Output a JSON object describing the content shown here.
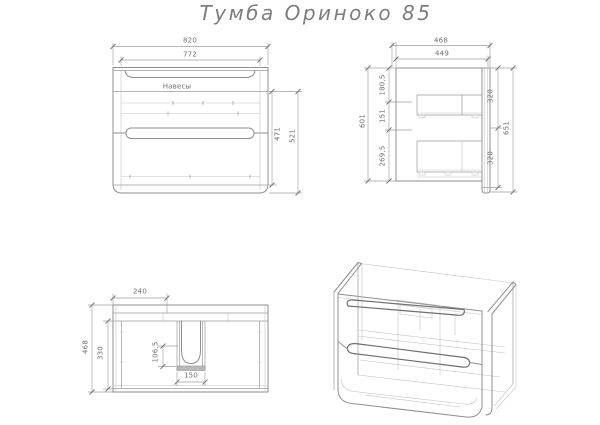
{
  "title": "Тумба  Ориноко  85",
  "front_view": {
    "shelf_label": "Навесы",
    "dim_width_outer": "820",
    "dim_width_inner": "772",
    "dim_height_inner": "471",
    "dim_height_outer": "521"
  },
  "side_view": {
    "dim_depth_outer": "468",
    "dim_depth_inner": "449",
    "dim_top_section": "180,5",
    "dim_mid_section": "151",
    "dim_bottom_section": "269,5",
    "dim_height_back": "601",
    "dim_front_top": "320",
    "dim_front_bottom": "320",
    "dim_height_front": "651"
  },
  "top_view": {
    "dim_offset": "240",
    "dim_depth_outer": "468",
    "dim_depth_inner": "330",
    "dim_cutout_depth": "106,5",
    "dim_cutout_width": "150"
  }
}
